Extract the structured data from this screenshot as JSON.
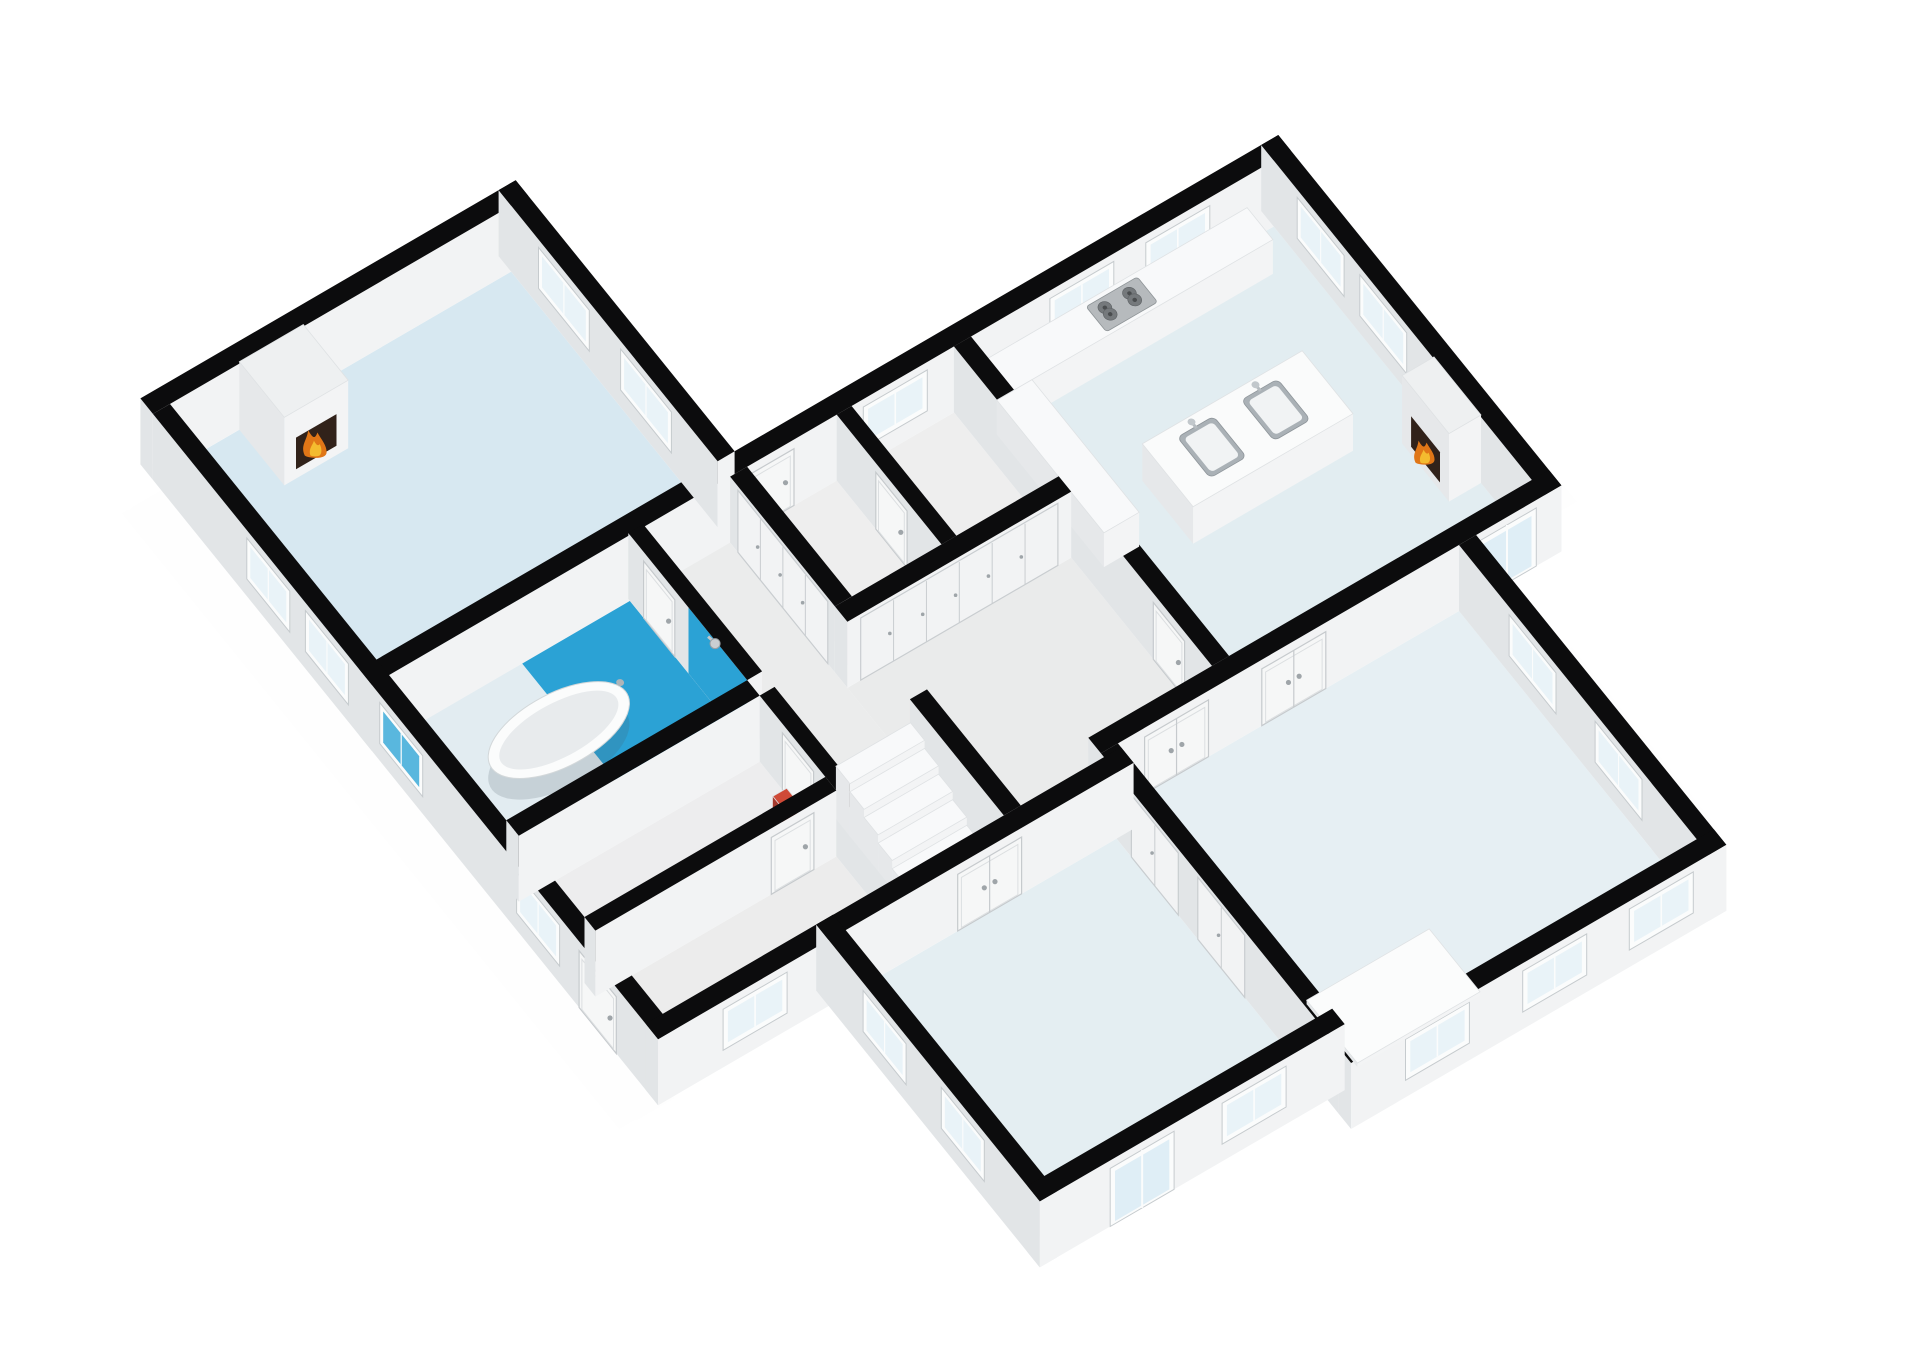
{
  "scene": {
    "canvas": {
      "width": 1920,
      "height": 1358,
      "background": "#ffffff"
    },
    "projection": {
      "origin": [
        170,
        470
      ],
      "axis_x": [
        53.3,
        -31.0
      ],
      "axis_y": [
        39.1,
        48.4
      ],
      "wall_height_px": 66
    },
    "palette": {
      "wall_cap": "#0c0c0d",
      "wall_face_shade": "#e2e5e7",
      "wall_face_light": "#f2f3f4",
      "box_face_shade": "#e6e8ea",
      "box_face_light": "#f3f4f5",
      "box_cap": "#f6f7f8",
      "box_cap_stroke": "#dfe2e4",
      "glass": "#e9f3f8",
      "glass_blue": "#59b7de",
      "frame": "#fbfcfc",
      "frame_stroke": "#c6cbce",
      "door_panel": "#f6f7f7",
      "door_stroke": "#c6cacd",
      "closet_panel": "#f2f3f4",
      "closet_stroke": "#c9cdd0",
      "handle": "#9fa5a9",
      "shower_blue": "#2ba2d5",
      "fire_opening": "#31221a",
      "fire_outer": "#e07617",
      "fire_inner": "#f4bb2f",
      "steel": "#aab1b6",
      "steel_dark": "#75797c",
      "shadow": "rgba(0,0,0,0.055)"
    },
    "floors": [
      {
        "name": "floor-living-room",
        "rect": [
          0,
          0,
          6.4,
          5.28
        ],
        "fill": "#d7e8f1"
      },
      {
        "name": "floor-bathroom",
        "rect": [
          0,
          5.56,
          4.52,
          8.6
        ],
        "fill": "#e2ecf1"
      },
      {
        "name": "floor-shower",
        "rect": [
          2.5,
          5.56,
          4.52,
          8.6
        ],
        "fill": "#2ba2d5"
      },
      {
        "name": "floor-corridor",
        "rect": [
          4.8,
          5.56,
          6.4,
          10.2
        ],
        "fill": "#ebecec"
      },
      {
        "name": "floor-stairwell",
        "rect": [
          4.8,
          10.2,
          6.4,
          12.6
        ],
        "fill": "#e9eaea"
      },
      {
        "name": "floor-storage",
        "rect": [
          0,
          8.92,
          4.52,
          10.6
        ],
        "fill": "#ededee"
      },
      {
        "name": "floor-entry",
        "rect": [
          0,
          10.88,
          4.52,
          12.6
        ],
        "fill": "#ececec"
      },
      {
        "name": "floor-utility-left",
        "rect": [
          6.72,
          5.6,
          8.4,
          8.28
        ],
        "fill": "#eeeeee"
      },
      {
        "name": "floor-utility-right",
        "rect": [
          8.68,
          5.6,
          10.6,
          8.28
        ],
        "fill": "#eeeeee"
      },
      {
        "name": "floor-hallway",
        "rect": [
          6.4,
          8.6,
          10.6,
          12.2
        ],
        "fill": "#eaebeb"
      },
      {
        "name": "floor-hallway-south",
        "rect": [
          6.4,
          12.2,
          8.28,
          12.6
        ],
        "fill": "#eaebeb"
      },
      {
        "name": "floor-kitchen",
        "rect": [
          10.92,
          5.6,
          16.6,
          12.2
        ],
        "fill": "#e2edf1"
      },
      {
        "name": "floor-bedroom-left",
        "rect": [
          3.2,
          12.92,
          8.28,
          18.0
        ],
        "fill": "#e4eef2"
      },
      {
        "name": "floor-bedroom-right",
        "rect": [
          8.6,
          12.52,
          15.0,
          18.6
        ],
        "fill": "#e6eff3"
      }
    ],
    "shadows": [
      {
        "rect": [
          -0.78,
          0.2,
          -0.32,
          12.95
        ]
      },
      {
        "rect": [
          -0.62,
          12.92,
          3.1,
          13.35
        ]
      },
      {
        "rect": [
          2.42,
          12.8,
          2.88,
          18.35
        ]
      },
      {
        "rect": [
          2.9,
          18.32,
          8.55,
          18.78
        ]
      },
      {
        "rect": [
          8.3,
          18.92,
          15.25,
          19.38
        ]
      },
      {
        "rect": [
          15.32,
          12.72,
          15.78,
          18.95
        ]
      },
      {
        "rect": [
          16.92,
          5.45,
          17.36,
          12.55
        ]
      }
    ],
    "walls": [
      {
        "name": "wall-living-north",
        "rect": [
          -0.32,
          -0.32,
          6.72,
          0
        ],
        "openings": []
      },
      {
        "name": "wall-west-exterior",
        "rect": [
          -0.32,
          0,
          0,
          12.92
        ],
        "openings": [
          {
            "type": "window",
            "side": "x",
            "a1": 2.4,
            "a2": 3.5
          },
          {
            "type": "window",
            "side": "x",
            "a1": 3.9,
            "a2": 5.0
          },
          {
            "type": "window",
            "side": "x",
            "a1": 5.8,
            "a2": 6.9,
            "glass": "#59b7de"
          },
          {
            "type": "window",
            "side": "x",
            "a1": 9.3,
            "a2": 10.4
          },
          {
            "type": "door",
            "side": "x",
            "a1": 10.9,
            "a2": 11.85
          }
        ]
      },
      {
        "name": "wall-living-east",
        "rect": [
          6.4,
          -0.32,
          6.72,
          5.28
        ],
        "openings": [
          {
            "type": "window",
            "side": "x",
            "a1": 0.7,
            "a2": 2.0
          },
          {
            "type": "window",
            "side": "x",
            "a1": 2.8,
            "a2": 4.1
          }
        ]
      },
      {
        "name": "wall-mid-band",
        "rect": [
          -0.32,
          5.28,
          16.92,
          5.6
        ],
        "openings": [
          {
            "type": "door",
            "side": "y",
            "a1": 6.8,
            "a2": 7.6
          },
          {
            "type": "window",
            "side": "y",
            "a1": 8.9,
            "a2": 10.1
          },
          {
            "type": "window",
            "side": "y",
            "a1": 12.4,
            "a2": 13.6,
            "z1": 0.3
          },
          {
            "type": "window",
            "side": "y",
            "a1": 14.2,
            "a2": 15.4,
            "z1": 0.3
          }
        ]
      },
      {
        "name": "wall-kitchen-east",
        "rect": [
          16.6,
          5.28,
          16.92,
          12.52
        ],
        "openings": [
          {
            "type": "window",
            "side": "x",
            "a1": 6.2,
            "a2": 7.4
          },
          {
            "type": "window",
            "side": "x",
            "a1": 7.8,
            "a2": 9.0
          }
        ]
      },
      {
        "name": "wall-kitchen-south",
        "rect": [
          8.28,
          12.2,
          16.92,
          12.52
        ],
        "openings": [
          {
            "type": "ddoor",
            "side": "y",
            "a1": 9.1,
            "a2": 10.3
          },
          {
            "type": "ddoor",
            "side": "y",
            "a1": 11.3,
            "a2": 12.5
          },
          {
            "type": "gdoor",
            "side": "y",
            "a1": 15.35,
            "a2": 16.45
          }
        ]
      },
      {
        "name": "wall-bedroom-right-east",
        "rect": [
          15.0,
          12.52,
          15.32,
          18.92
        ],
        "openings": [
          {
            "type": "window",
            "side": "x",
            "a1": 13.8,
            "a2": 15.0
          },
          {
            "type": "window",
            "side": "x",
            "a1": 16.0,
            "a2": 17.2
          }
        ]
      },
      {
        "name": "wall-bedroom-right-south",
        "rect": [
          8.28,
          18.6,
          15.32,
          18.92
        ],
        "openings": [
          {
            "type": "window",
            "side": "y",
            "a1": 9.3,
            "a2": 10.5
          },
          {
            "type": "window",
            "side": "y",
            "a1": 11.5,
            "a2": 12.7
          },
          {
            "type": "window",
            "side": "y",
            "a1": 13.5,
            "a2": 14.7
          }
        ]
      },
      {
        "name": "wall-bedroom-left-south",
        "rect": [
          2.88,
          18.0,
          8.6,
          18.32
        ],
        "openings": [
          {
            "type": "gdoor",
            "side": "y",
            "a1": 4.2,
            "a2": 5.4
          },
          {
            "type": "window",
            "side": "y",
            "a1": 6.3,
            "a2": 7.5
          }
        ]
      },
      {
        "name": "wall-bedroom-left-west",
        "rect": [
          2.88,
          12.6,
          3.2,
          18.32
        ],
        "openings": [
          {
            "type": "window",
            "side": "x",
            "a1": 13.8,
            "a2": 14.9
          },
          {
            "type": "window",
            "side": "x",
            "a1": 15.8,
            "a2": 16.9
          }
        ]
      },
      {
        "name": "wall-entry-south",
        "rect": [
          -0.32,
          12.6,
          3.2,
          12.92
        ],
        "openings": [
          {
            "type": "window",
            "side": "y",
            "a1": 0.9,
            "a2": 2.1
          }
        ]
      },
      {
        "name": "wall-bath-corridor",
        "rect": [
          4.52,
          5.56,
          4.8,
          8.6
        ],
        "openings": [
          {
            "type": "door",
            "side": "x",
            "a1": 5.95,
            "a2": 6.75
          }
        ],
        "decals": [
          {
            "side": "x",
            "a1": 7.1,
            "a2": 8.6,
            "fill": "#2ba2d5"
          }
        ]
      },
      {
        "name": "wall-bath-south",
        "rect": [
          0,
          8.6,
          4.52,
          8.92
        ],
        "openings": []
      },
      {
        "name": "wall-storage-east",
        "rect": [
          4.52,
          8.92,
          4.8,
          12.6
        ],
        "openings": [
          {
            "type": "door",
            "side": "x",
            "a1": 9.5,
            "a2": 10.3
          }
        ]
      },
      {
        "name": "wall-corridor-closets",
        "rect": [
          6.4,
          5.6,
          6.72,
          8.28
        ],
        "openings": [
          {
            "type": "closet",
            "side": "x",
            "a1": 5.8,
            "a2": 8.1
          }
        ]
      },
      {
        "name": "wall-stair-east",
        "rect": [
          6.4,
          10.2,
          6.72,
          12.6
        ],
        "openings": []
      },
      {
        "name": "wall-utility-divider",
        "rect": [
          8.4,
          5.6,
          8.68,
          8.28
        ],
        "openings": [
          {
            "type": "door",
            "side": "x",
            "a1": 6.6,
            "a2": 7.4
          }
        ]
      },
      {
        "name": "wall-hall-closets",
        "rect": [
          6.4,
          8.28,
          10.6,
          8.6
        ],
        "openings": [
          {
            "type": "closet",
            "side": "y",
            "a1": 6.65,
            "a2": 10.35
          }
        ]
      },
      {
        "name": "wall-hall-kitchen",
        "rect": [
          10.6,
          5.6,
          10.92,
          12.2
        ],
        "openings": [
          {
            "type": "door",
            "side": "x",
            "a1": 10.7,
            "a2": 11.5
          }
        ]
      },
      {
        "name": "wall-storage-entry",
        "rect": [
          0,
          10.6,
          4.52,
          10.88
        ],
        "openings": [
          {
            "type": "door",
            "side": "y",
            "a1": 3.3,
            "a2": 4.1
          }
        ]
      },
      {
        "name": "wall-hall-bedroom-left",
        "rect": [
          2.88,
          12.6,
          8.6,
          12.92
        ],
        "openings": [
          {
            "type": "ddoor",
            "side": "y",
            "a1": 5.3,
            "a2": 6.5
          }
        ]
      },
      {
        "name": "wall-bedrooms-divider",
        "rect": [
          8.28,
          12.52,
          8.6,
          18.6
        ],
        "openings": [
          {
            "type": "closet",
            "side": "x",
            "a1": 13.3,
            "a2": 14.5
          },
          {
            "type": "closet",
            "side": "x",
            "a1": 15.0,
            "a2": 16.2
          }
        ]
      }
    ],
    "fixtures": [
      {
        "name": "fireplace-living",
        "type": "box",
        "rect": [
          1.3,
          0,
          2.5,
          1.15
        ],
        "h": 1.03,
        "cap": "#eef0f1",
        "fire": {
          "side": "y",
          "a1": 1.52,
          "a2": 2.28,
          "z1": 0.14,
          "z2": 0.62,
          "s": 1.15
        }
      },
      {
        "name": "fireplace-kitchen",
        "type": "box",
        "rect": [
          16.0,
          9.7,
          16.6,
          10.9
        ],
        "h": 1.03,
        "cap": "#eef0f1",
        "fire": {
          "side": "x",
          "a1": 9.93,
          "a2": 10.67,
          "z1": 0.12,
          "z2": 0.58,
          "s": 1.0
        }
      },
      {
        "name": "kitchen-counter-top",
        "type": "box",
        "rect": [
          10.92,
          5.6,
          16.1,
          6.26
        ],
        "h": 0.52,
        "cap": "#f8f9fa"
      },
      {
        "name": "kitchen-counter-side",
        "type": "box",
        "rect": [
          10.92,
          6.26,
          11.58,
          9.0
        ],
        "h": 0.52,
        "cap": "#f8f9fa"
      },
      {
        "name": "kitchen-island",
        "type": "box",
        "rect": [
          12.3,
          8.1,
          15.3,
          9.4
        ],
        "h": 0.56,
        "cap": "#fafbfb"
      },
      {
        "name": "gas-hob",
        "type": "hob",
        "rect": [
          13.02,
          5.68,
          13.98,
          6.2
        ],
        "z": 0.525
      },
      {
        "name": "island-sink-left",
        "type": "sink",
        "cx": 13.15,
        "cy": 8.72,
        "z": 0.565
      },
      {
        "name": "island-sink-right",
        "type": "sink",
        "cx": 14.35,
        "cy": 8.72,
        "z": 0.565
      },
      {
        "name": "bathtub",
        "type": "tub",
        "cx": 2.05,
        "cy": 7.15,
        "rx": 1.25,
        "ry": 0.6,
        "z": 0.34
      },
      {
        "name": "shower-head",
        "type": "shower-head",
        "x": 4.52,
        "y": 7.6,
        "z": 0.82
      },
      {
        "name": "staircase",
        "type": "stairs",
        "rect": [
          4.9,
          10.35,
          6.3,
          12.51
        ],
        "steps": 6
      },
      {
        "name": "floor-mat",
        "type": "box",
        "rect": [
          9.0,
          16.8,
          11.3,
          18.1
        ],
        "h": 0.06,
        "cap": "#fbfcfc"
      },
      {
        "name": "red-object",
        "type": "box",
        "rect": [
          4.18,
          9.72,
          4.44,
          9.98
        ],
        "h": 0.22,
        "cap": "#cf4a37",
        "sx": "#a53a2e",
        "sy": "#d2584a"
      }
    ]
  }
}
